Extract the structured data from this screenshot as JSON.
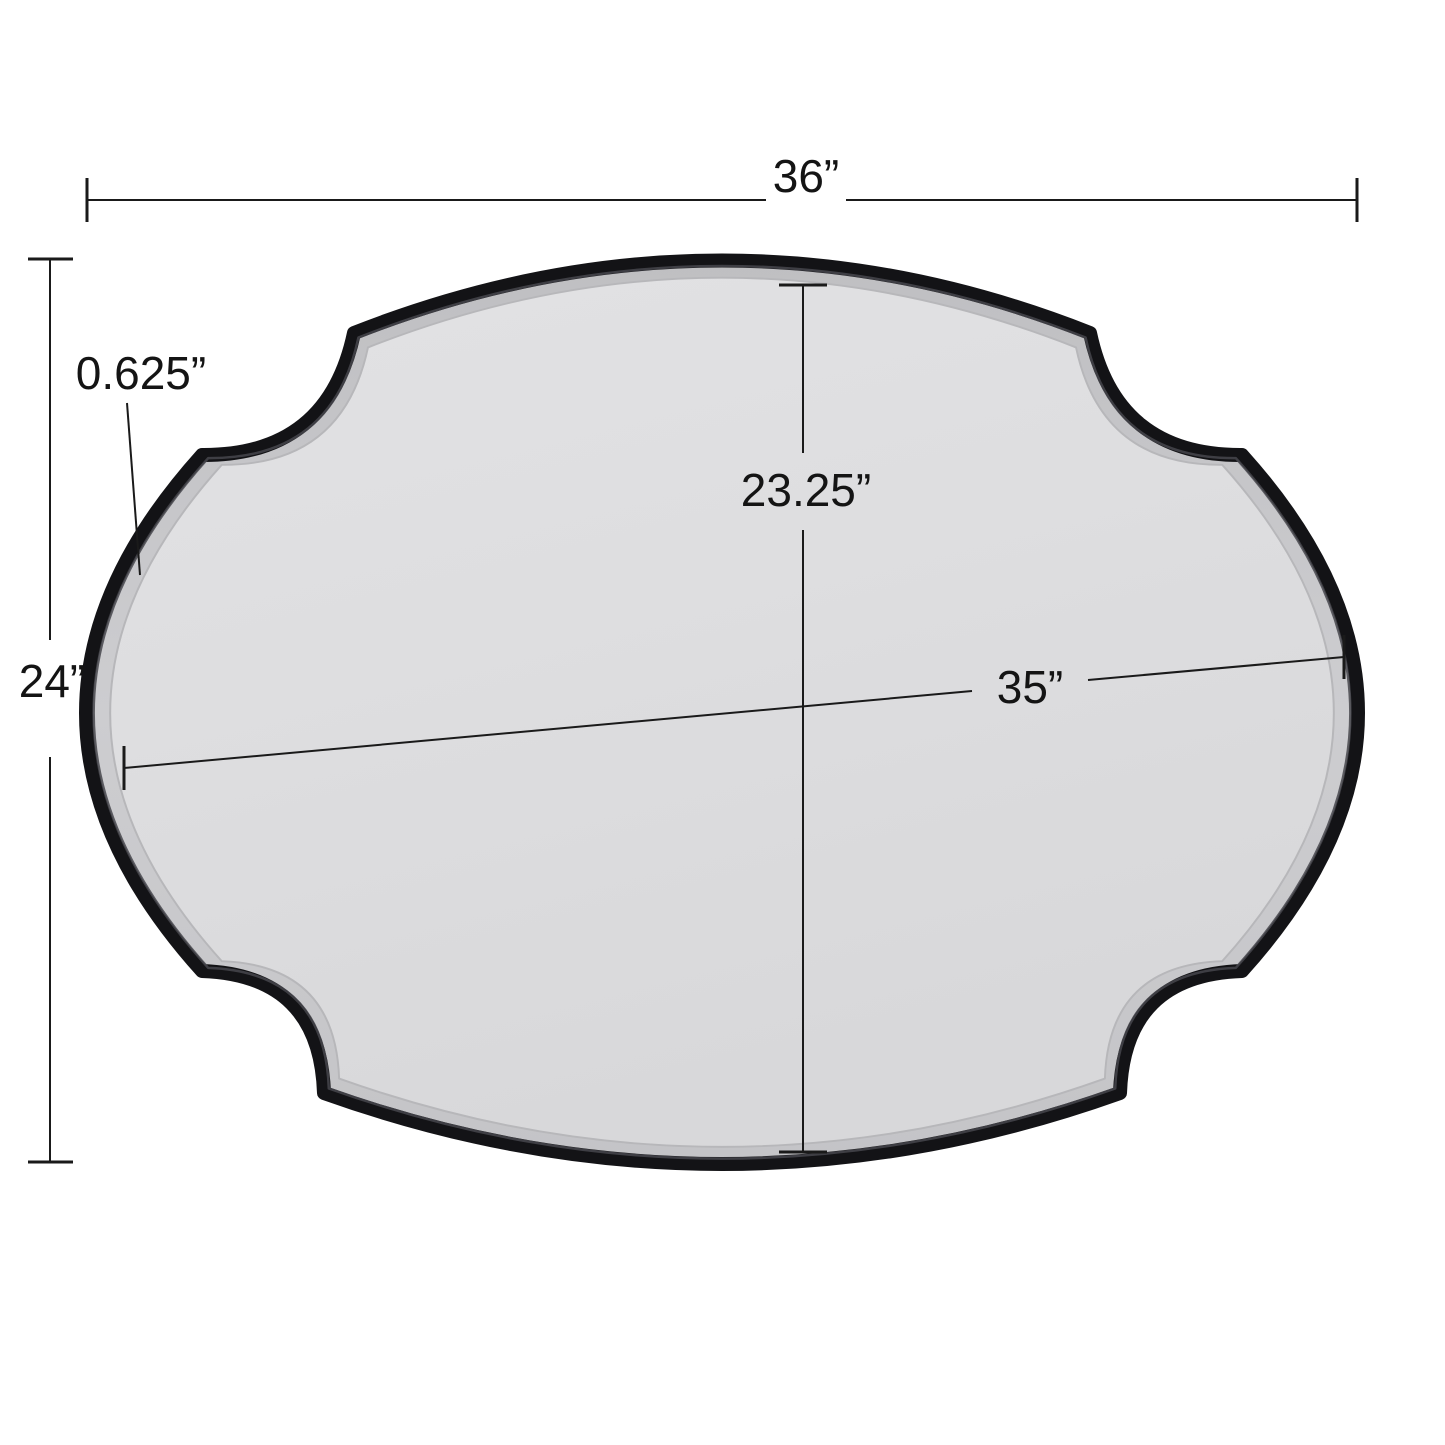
{
  "diagram": {
    "subject": "scalloped-oval-wall-mirror-dimension-diagram",
    "frame_style": "black scalloped frame with beveled mirror glass",
    "measurements": {
      "overall_width": {
        "label": "36”"
      },
      "overall_height": {
        "label": "24”"
      },
      "frame_depth": {
        "label": "0.625”"
      },
      "glass_height": {
        "label": "23.25”"
      },
      "glass_width": {
        "label": "35”"
      }
    },
    "colors": {
      "background": "#ffffff",
      "frame": "#131316",
      "frame_ridge_highlight": "#46464c",
      "bevel_band_light": "#cdcdd0",
      "bevel_band_dark": "#bfbfc2",
      "glass_light": "#e6e6e8",
      "glass_dark": "#d8d8da",
      "dimension_line": "#1a1a1a",
      "label_text": "#141414"
    }
  }
}
